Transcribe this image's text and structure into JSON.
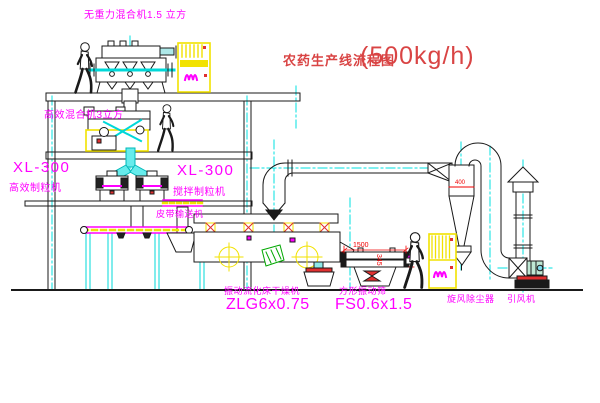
{
  "title": {
    "name": "农药生产线流程图",
    "capacity": "(500kg/h)"
  },
  "labels": {
    "gravity_mixer": "无重力混合机1.5 立方",
    "high_eff_mixer": "高效混合机3立方",
    "granulator_left_model": "XL-300",
    "granulator_left_name": "高效制粒机",
    "granulator_right_model": "XL-300",
    "granulator_right_name": "搅拌制粒机",
    "belt_conveyor": "皮带输送机",
    "dryer_name": "振动流化床干燥机",
    "dryer_model": "ZLG6x0.75",
    "sieve_name": "方形振动筛",
    "sieve_model": "FS0.6x1.5",
    "cyclone": "旋风除尘器",
    "fan": "引风机"
  },
  "dims": {
    "sieve_length": "1500",
    "sieve_height": "345",
    "cyclone_diameter": "400"
  },
  "colors": {
    "label_magenta": "#ff00ff",
    "title_red": "#d94444",
    "dimension_red": "#f00000",
    "centerline_cyan": "#00e0e0",
    "equipment_yellow": "#f2e200",
    "line_black": "#1a1a1a",
    "accent_green": "#00a800",
    "background": "#ffffff"
  }
}
